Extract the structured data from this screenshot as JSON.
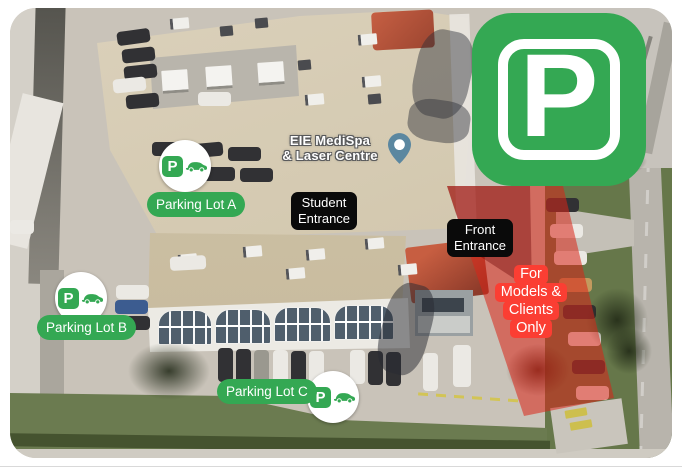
{
  "colors": {
    "brand_green": "#34a853",
    "restricted_red": "#fb3e33",
    "overlay_red": "rgba(216,36,24,0.55)",
    "label_black": "#0a0a0a",
    "place_pin_blue": "#5b87a0"
  },
  "map": {
    "place": {
      "name_line1": "EIE MediSpa",
      "name_line2": "& Laser Centre"
    },
    "labels": {
      "student_entrance": [
        "Student",
        "Entrance"
      ],
      "front_entrance": [
        "Front",
        "Entrance"
      ],
      "restricted": [
        "For",
        "Models &",
        "Clients",
        "Only"
      ]
    },
    "parking": {
      "big_icon_letter": "P",
      "marker_letter": "P",
      "lots": [
        {
          "label": "Parking Lot A"
        },
        {
          "label": "Parking Lot B"
        },
        {
          "label": "Parking Lot C"
        }
      ]
    }
  }
}
